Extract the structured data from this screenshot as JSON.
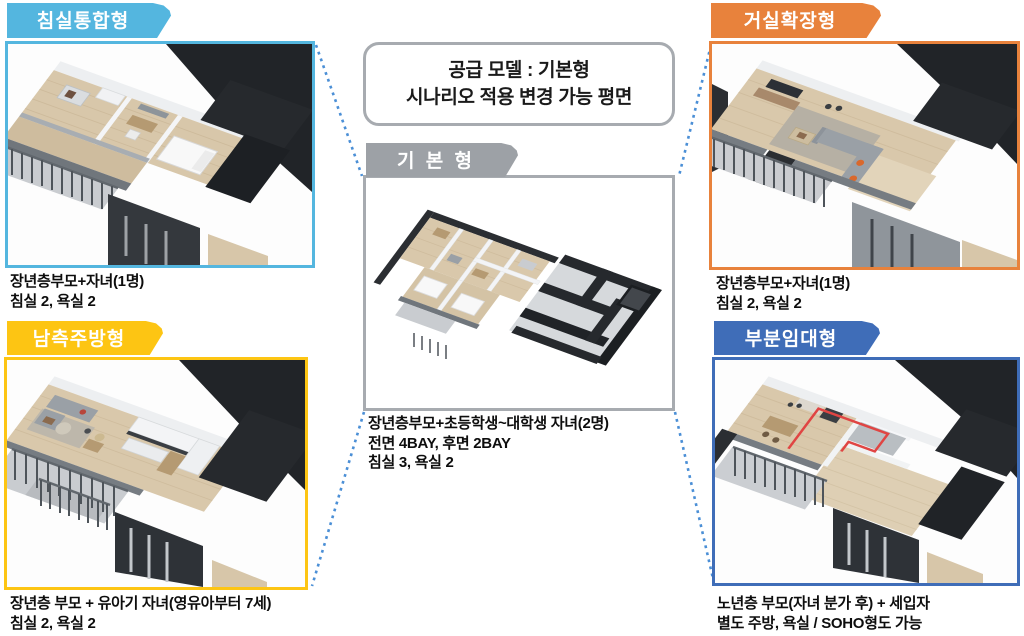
{
  "header_box": {
    "line1": "공급 모델 : 기본형",
    "line2": "시나리오 적용 변경 가능 평면",
    "border_color": "#a7abb0",
    "text_color": "#1a1a1a"
  },
  "center": {
    "tab_label": "기 본 형",
    "tab_color": "#9da1a6",
    "panel_border_color": "#a7abb0",
    "caption_lines": [
      "장년층부모+초등학생~대학생 자녀(2명)",
      "전면 4BAY, 후면 2BAY",
      "침실 3, 욕실 2"
    ]
  },
  "variants": [
    {
      "id": "bedroom-integrated",
      "position": "top-left",
      "tab_label": "침실통합형",
      "accent_color": "#54b6df",
      "caption_lines": [
        "장년층부모+자녀(1명)",
        "침실 2, 욕실 2"
      ]
    },
    {
      "id": "living-extension",
      "position": "top-right",
      "tab_label": "거실확장형",
      "accent_color": "#e8823c",
      "caption_lines": [
        "장년층부모+자녀(1명)",
        "침실 2, 욕실 2"
      ]
    },
    {
      "id": "south-kitchen",
      "position": "bottom-left",
      "tab_label": "남측주방형",
      "accent_color": "#fdc513",
      "caption_lines": [
        "장년층 부모 + 유아기 자녀(영유아부터 7세)",
        "침실 2, 욕실 2"
      ]
    },
    {
      "id": "partial-rental",
      "position": "bottom-right",
      "tab_label": "부분임대형",
      "accent_color": "#3f6db8",
      "caption_lines": [
        "노년층 부모(자녀 분가 후) + 세입자",
        "별도 주방, 욕실 / SOHO형도 가능"
      ]
    }
  ],
  "connector": {
    "color": "#4b8fd6",
    "style": "dotted"
  },
  "rental_highlight_color": "#e04543",
  "floorplan_palette": {
    "wood_floor": "#d9c8ab",
    "dark_wall": "#26292d",
    "light_wall": "#edeff1",
    "gray_floor": "#d6d9dc"
  }
}
